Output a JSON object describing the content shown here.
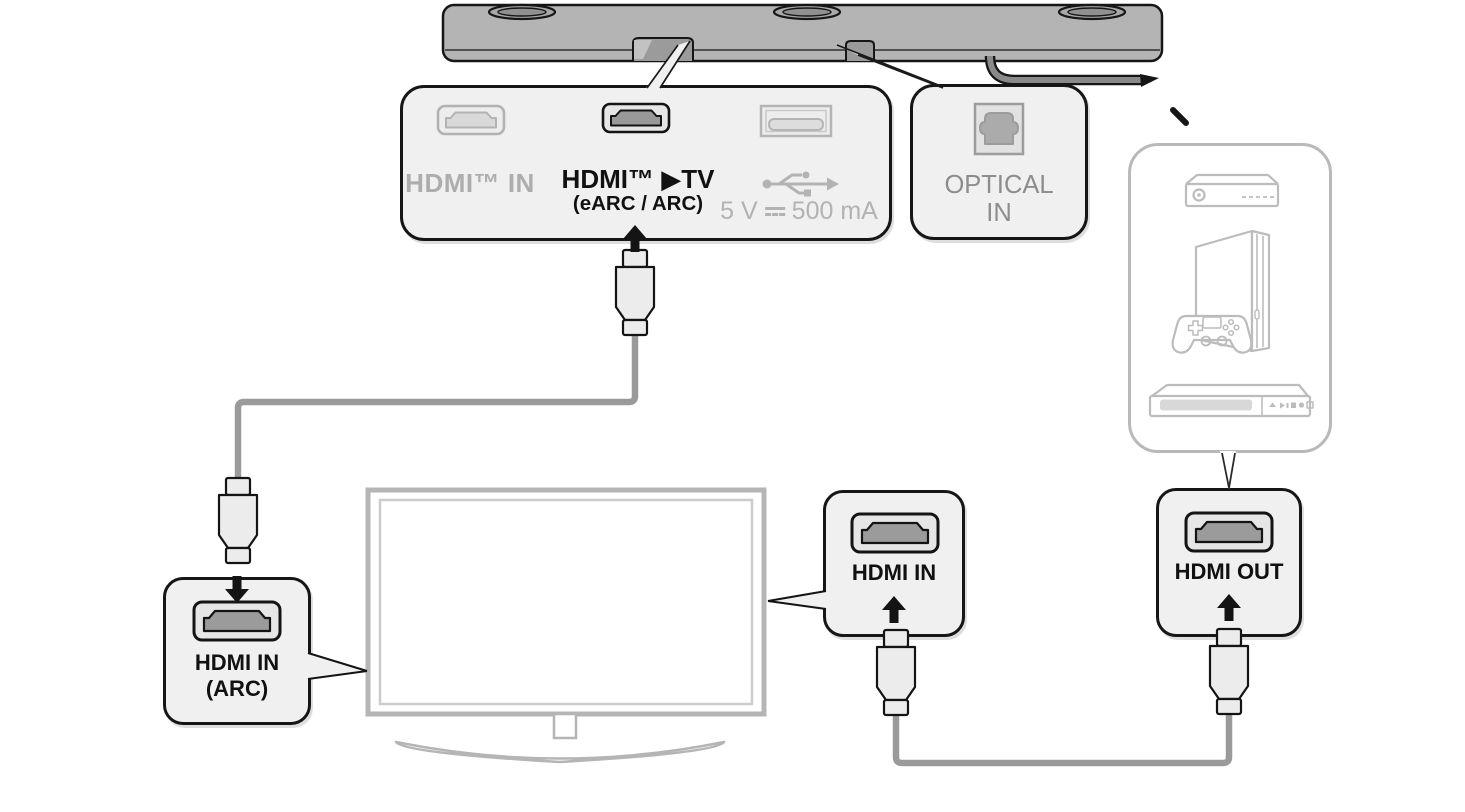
{
  "diagram_title": "Soundbar HDMI / optical connection diagram",
  "rear_panel": {
    "hdmi_in": {
      "label": "HDMI™ IN"
    },
    "hdmi_tv": {
      "label": "HDMI™ ▶TV",
      "sublabel": "(eARC / ARC)"
    },
    "usb": {
      "power_prefix": "5 V",
      "power_suffix": "500 mA"
    }
  },
  "optical_panel": {
    "line1": "OPTICAL",
    "line2": "IN"
  },
  "tv_callouts": {
    "hdmi_in_arc": {
      "line1": "HDMI IN",
      "line2": "(ARC)"
    },
    "hdmi_in": {
      "label": "HDMI IN"
    }
  },
  "device_callout": {
    "hdmi_out": {
      "label": "HDMI OUT"
    }
  },
  "icons": [
    "soundbar",
    "hdmi-port-icon",
    "usb-port-icon",
    "optical-port-icon",
    "usb-symbol-icon",
    "dc-power-icon",
    "arrow-up-icon",
    "arrow-down-icon",
    "hdmi-plug-icon",
    "power-cord",
    "tv",
    "set-top-box-icon",
    "game-console-icon",
    "dvd-player-icon"
  ],
  "colors": {
    "background": "#ffffff",
    "soundbar_gray": "#b4b4b4",
    "panel_fill": "#f0f0f0",
    "outline_black": "#161616",
    "muted_text": "#adadad",
    "optical_text": "#8d8d8d",
    "cable_gray": "#9a9a9a",
    "device_outline_gray": "#bcbcbc",
    "port_dark_fill": "#9b9b9b"
  }
}
